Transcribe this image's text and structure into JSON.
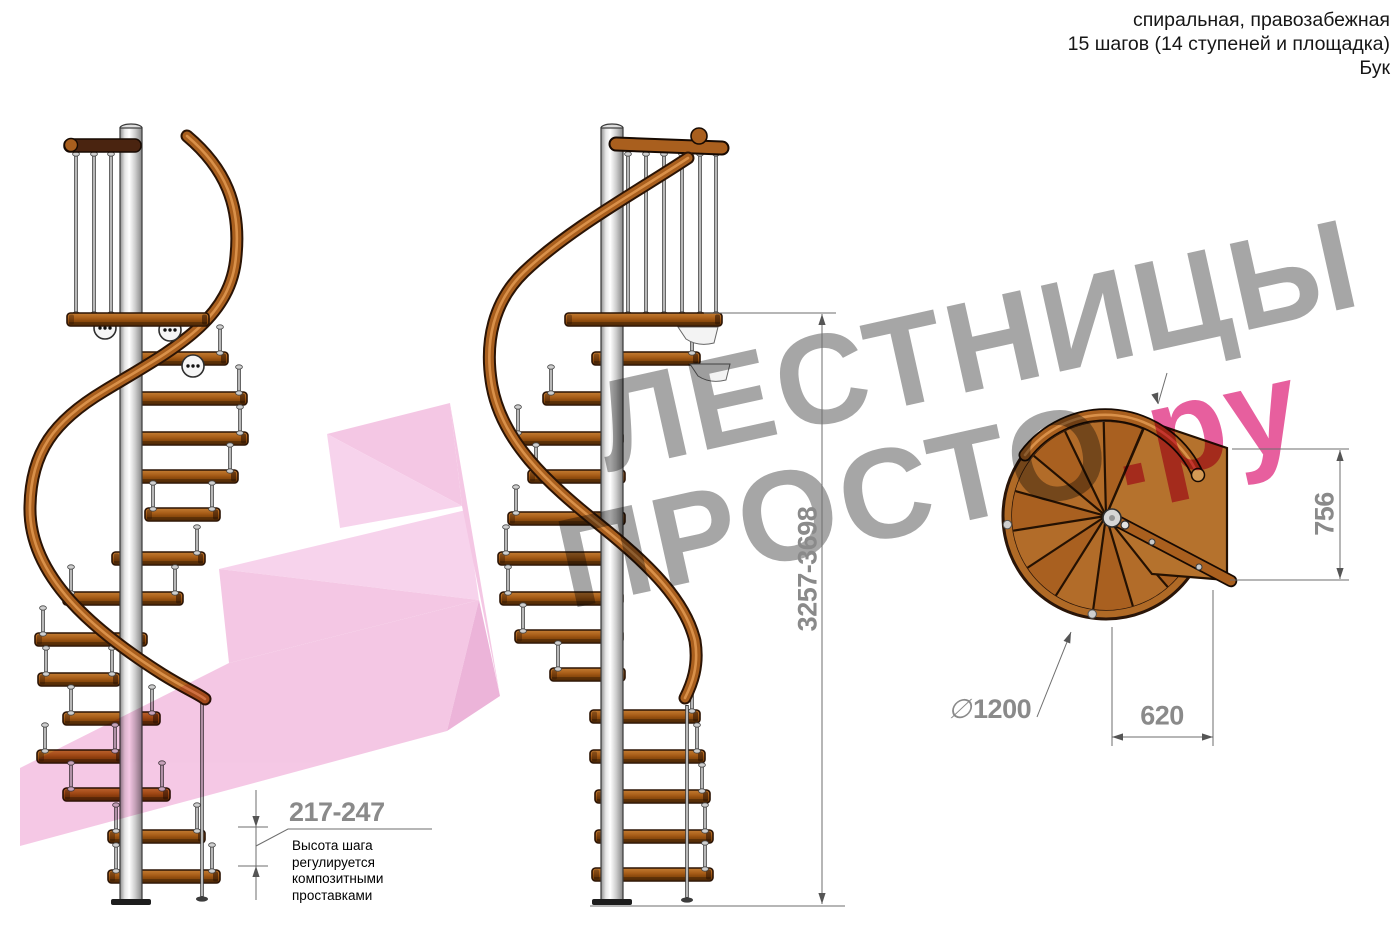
{
  "header": {
    "line1": "спиральная, правозабежная",
    "line2": "15 шагов (14 ступеней и площадка)",
    "line3": "Бук"
  },
  "watermark": {
    "line1": "ЛЕСТНИЦЫ",
    "line2": "ПРОСТО",
    "line2_suffix": ".ру",
    "text_color": "#a6a6a6",
    "accent_color": "#e75f9e",
    "logo_light": "#f6c8e8",
    "logo_mid": "#f2bade",
    "logo_dark": "#e8a2d0"
  },
  "dimensions": {
    "total_height": "3257-3698",
    "step_rise": "217-247",
    "landing_depth": "756",
    "step_width": "620",
    "diameter_symbol": "∅",
    "diameter_value": "1200",
    "rise_note_lines": [
      "Высота шага",
      "регулируется",
      "композитными",
      "проставками"
    ]
  },
  "colors": {
    "wood": "#a95f1e",
    "wood_dark": "#2b1405",
    "wood_light": "#d99049",
    "metal_light": "#ececec",
    "metal_dark": "#3f3f3f",
    "dim_text": "#8a8a8a",
    "dim_line": "#6e6e6e"
  }
}
